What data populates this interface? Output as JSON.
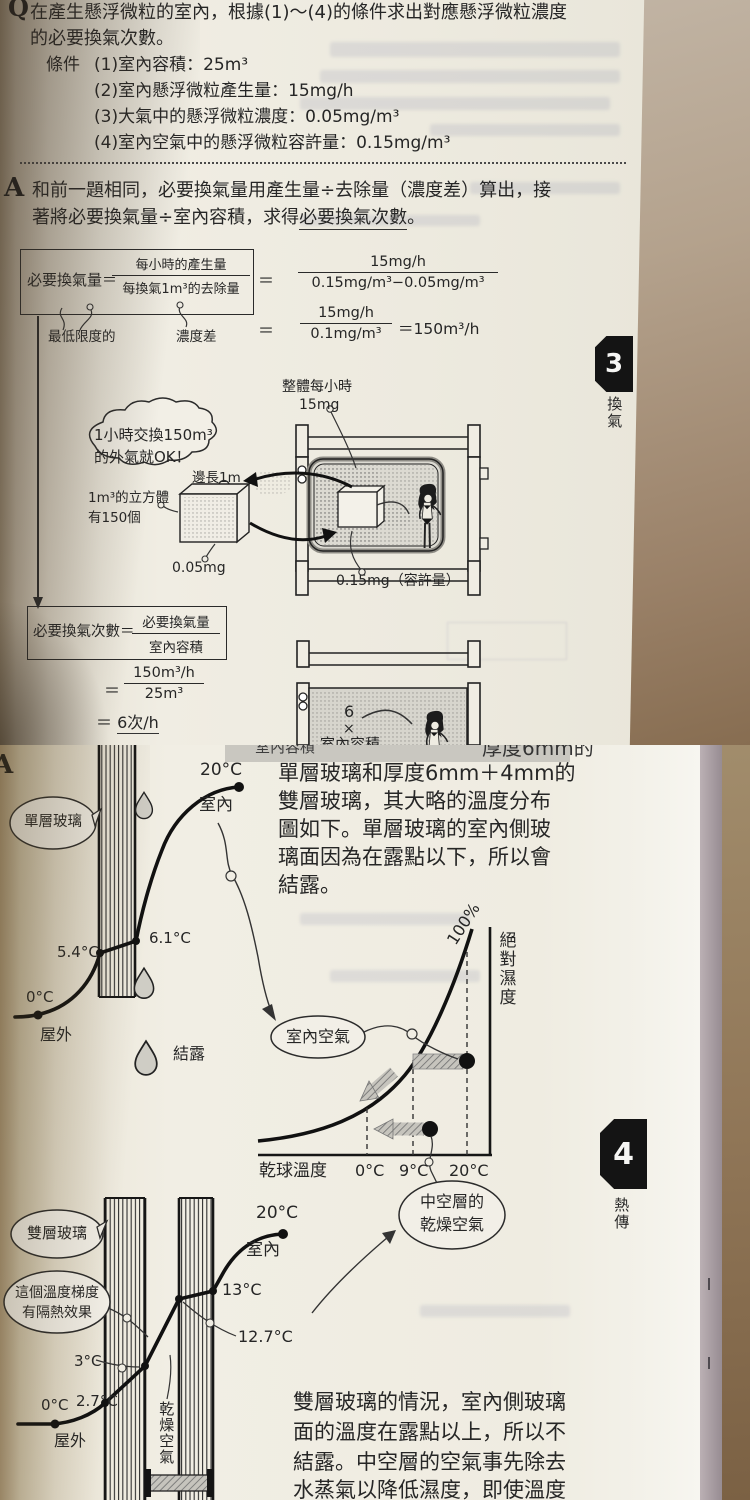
{
  "page1": {
    "q_label": "Q",
    "q_line1": "在產生懸浮微粒的室內，根據(1)～(4)的條件求出對應懸浮微粒濃度",
    "q_line2": "的必要換氣次數。",
    "cond_label": "條件",
    "cond1": "(1)室內容積：25m³",
    "cond2": "(2)室內懸浮微粒產生量：15mg/h",
    "cond3": "(3)大氣中的懸浮微粒濃度：0.05mg/m³",
    "cond4": "(4)室內空氣中的懸浮微粒容許量：0.15mg/m³",
    "a_label": "A",
    "a_line1": "和前一題相同，必要換氣量用產生量÷去除量（濃度差）算出，接",
    "a_line2_pre": "著將必要換氣量÷室內容積，求得",
    "a_line2_ul": "必要換氣次數",
    "a_line2_post": "。",
    "formula1": {
      "lhs": "必要換氣量＝",
      "num": "每小時的產生量",
      "den": "每換氣1m³的去除量",
      "eq1": "＝",
      "eq1_num": "15mg/h",
      "eq1_den": "0.15mg/m³−0.05mg/m³",
      "eq2": "＝",
      "eq2_num": "15mg/h",
      "eq2_den": "0.1mg/m³",
      "eq2_result": "＝150m³/h"
    },
    "label_min": "最低限度的",
    "label_diff": "濃度差",
    "diagram": {
      "bubble_line1": "1小時交換150m³",
      "bubble_line2": "的外氣就OK！",
      "label_total1": "整體每小時",
      "label_total2": "15mg",
      "label_edge": "邊長1m",
      "label_cube1": "1m³的立方體",
      "label_cube2": "有150個",
      "label_005": "0.05mg",
      "label_015": "0.15mg（容許量）"
    },
    "tab3": {
      "num": "3",
      "label": "換氣"
    },
    "formula2": {
      "lhs": "必要換氣次數＝",
      "num": "必要換氣量",
      "den": "室內容積",
      "eq1": "＝",
      "eq1_num": "150m³/h",
      "eq1_den": "25m³",
      "result_eq": "＝ ",
      "result_val": "6次/h"
    },
    "diagram2": {
      "line1": "6",
      "line2": "×",
      "line3": "室內容積"
    }
  },
  "page2": {
    "remnant_left": "室內容積",
    "remnant_right": "厚度6mm的",
    "a_label": "A",
    "para1": [
      "單層玻璃和厚度6mm＋4mm的",
      "雙層玻璃，其大略的溫度分布",
      "圖如下。單層玻璃的室內側玻",
      "璃面因為在露點以下，所以會",
      "結露。"
    ],
    "single": {
      "bubble": "單層玻璃",
      "t_in": "20°C",
      "label_in": "室內",
      "t_61": "6.1°C",
      "t_54": "5.4°C",
      "t_out": "0°C",
      "label_out": "屋外",
      "label_cond": "結露"
    },
    "chart": {
      "label_100": "100%",
      "ylabel": "絕對濕度",
      "xlabel": "乾球溫度",
      "tick0": "0°C",
      "tick9": "9°C",
      "tick20": "20°C",
      "bubble_indoor": "室內空氣",
      "bubble_cavity1": "中空層的",
      "bubble_cavity2": "乾燥空氣"
    },
    "chart_data": {
      "type": "line",
      "xlabel": "乾球溫度",
      "ylabel": "絕對濕度",
      "x_ticks": [
        "0°C",
        "9°C",
        "20°C"
      ],
      "series": [
        {
          "name": "100%",
          "description": "飽和曲線（相對濕度100%）"
        }
      ],
      "points": [
        {
          "label": "室內空氣",
          "x": "20°C",
          "note": "露點9°C，冷卻至9°C即達飽和"
        },
        {
          "label": "中空層的乾燥空氣",
          "x": "9°C",
          "note": "濕度低，不結露"
        }
      ]
    },
    "tab4": {
      "num": "4",
      "label": "熱傳"
    },
    "double": {
      "bubble1": "雙層玻璃",
      "bubble2_line1": "這個溫度梯度",
      "bubble2_line2": "有隔熱效果",
      "t_in": "20°C",
      "label_in": "室內",
      "t_13": "13°C",
      "t_127": "12.7°C",
      "t_3": "3°C",
      "t_27": "2.7°C",
      "t_out": "0°C",
      "label_out": "屋外",
      "label_dry": "乾燥空氣"
    },
    "para2": [
      "雙層玻璃的情況，室內側玻璃",
      "面的溫度在露點以上，所以不",
      "結露。中空層的空氣事先除去",
      "水蒸氣以降低濕度，即使溫度"
    ]
  }
}
